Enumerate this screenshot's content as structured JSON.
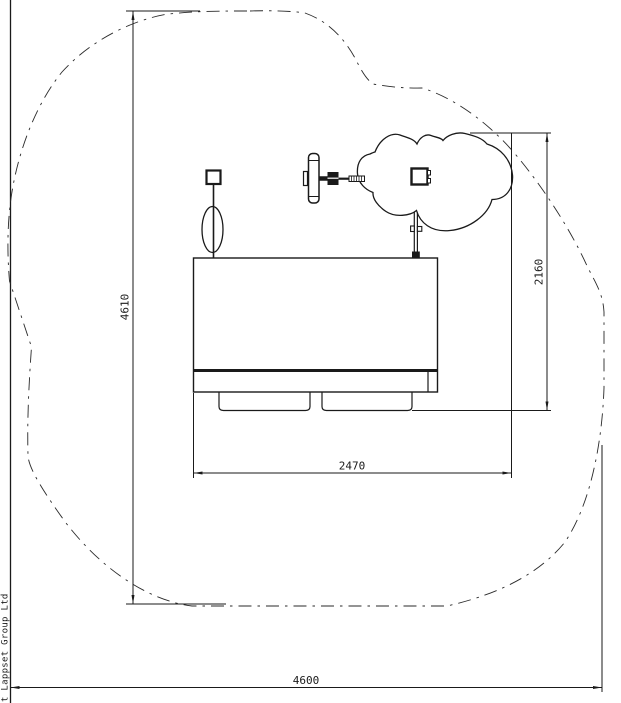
{
  "drawing": {
    "dimensions": {
      "total_height_mm": "4610",
      "panel_height_mm": "2160",
      "unit_width_mm": "2470",
      "total_width_mm": "4600"
    },
    "footer": {
      "copyright": "t Lappset Group Ltd"
    },
    "colors": {
      "line": "#1a1a1a",
      "background": "#ffffff"
    }
  }
}
